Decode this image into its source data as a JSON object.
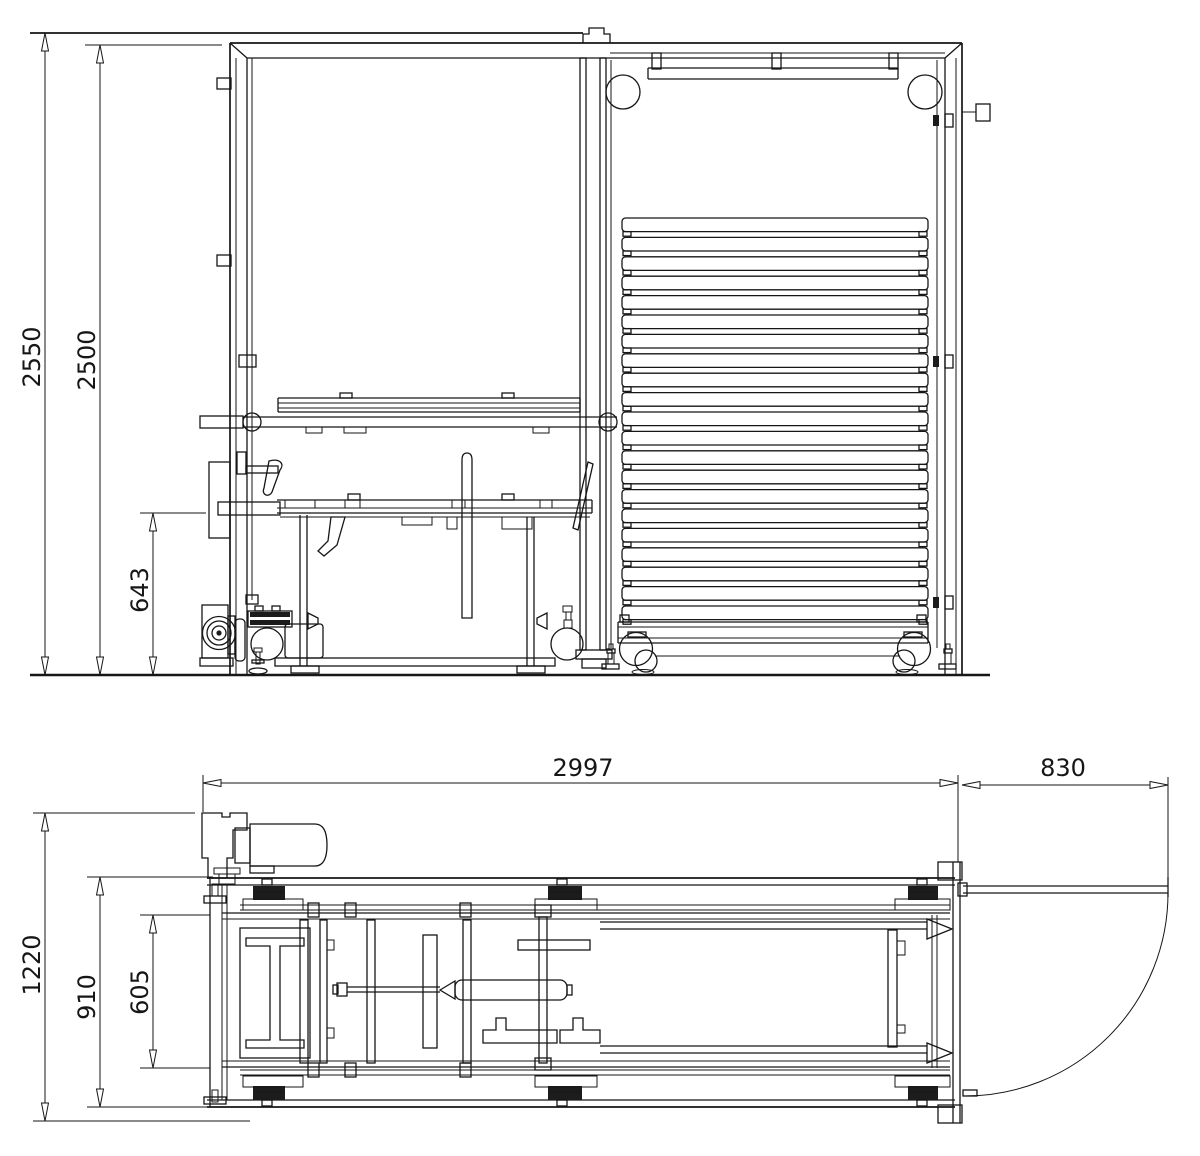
{
  "drawing": {
    "type": "engineering-2-view-drawing",
    "background_color": "#ffffff",
    "line_color": "#161616",
    "views": {
      "front": {
        "name": "front-elevation",
        "dimensions": {
          "overall_height": {
            "label": "2550"
          },
          "frame_height": {
            "label": "2500"
          },
          "table_height": {
            "label": "643"
          }
        }
      },
      "plan": {
        "name": "plan-view",
        "dimensions": {
          "overall_length": {
            "label": "2997"
          },
          "door_swing": {
            "label": "830"
          },
          "overall_depth": {
            "label": "1220"
          },
          "frame_depth": {
            "label": "910"
          },
          "carriage_width": {
            "label": "605"
          }
        }
      }
    },
    "geometry": {
      "slat_stack": {
        "count": 21,
        "x": 622,
        "width": 306,
        "top": 218,
        "pitch": 19.4,
        "slat_height": 13.6
      }
    }
  }
}
